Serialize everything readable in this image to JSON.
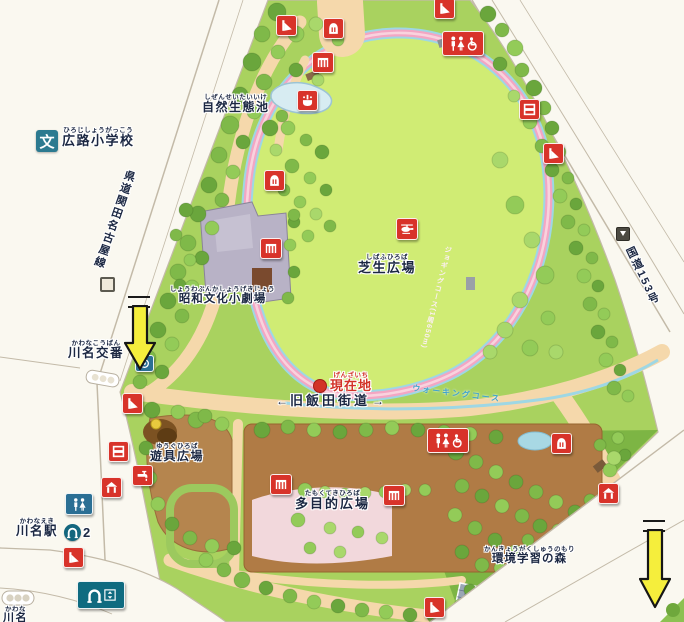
{
  "labels": {
    "school": {
      "text": "広路小学校",
      "furigana": "ひろじしょうがっこう",
      "symbol": "文"
    },
    "eco_pond": {
      "text": "自然生態池",
      "furigana": "しぜんせいたいいけ"
    },
    "pref_road": {
      "text": "県道関田名古屋線"
    },
    "theater": {
      "text": "昭和文化小劇場",
      "furigana": "しょうわぶんかしょうげきじょう"
    },
    "koban": {
      "text": "川名交番",
      "furigana": "かわなこうばん"
    },
    "lawn_plaza": {
      "text": "芝生広場",
      "furigana": "しばふひろば"
    },
    "current_location": {
      "text": "現在地",
      "furigana": "げんざいち"
    },
    "old_iida_road": {
      "text": "旧飯田街道",
      "left_arrow": "←",
      "right_arrow": "→"
    },
    "playground": {
      "text": "遊具広場",
      "furigana": "ゆうぐひろば"
    },
    "multipurpose": {
      "text": "多目的広場",
      "furigana": "たもくてきひろば"
    },
    "station": {
      "text": "川名駅",
      "furigana": "かわなえき",
      "exit_number": "2"
    },
    "station_corner": {
      "text": "川名",
      "furigana": "かわな"
    },
    "forest": {
      "text": "環境学習の森",
      "furigana": "かんきょうがくしゅうのもり"
    },
    "route153": {
      "text": "国道153号"
    },
    "jogging_course": {
      "text": "ジョギングコース(1周650m)"
    },
    "walking_course": {
      "text": "ウォーキングコース"
    }
  },
  "colors": {
    "lawn": "#d0ec74",
    "park_green": "#a9d25f",
    "forest_green": "#7db544",
    "path_tan": "#f5d8ab",
    "plaza_brown": "#b07b45",
    "jogging_pink": "#f3a6c3",
    "walking_blue": "#9ed7e4",
    "icon_red": "#d8332a",
    "icon_blue": "#2b6f94",
    "subway_teal": "#0f6b80",
    "arrow_yellow": "#f5ee3c"
  },
  "icons": [
    {
      "name": "slide-icon-north",
      "type": "slide",
      "x": 285,
      "y": 24
    },
    {
      "name": "slide-icon-top-entrance",
      "type": "slide",
      "x": 443,
      "y": 7
    },
    {
      "name": "arbor-icon-north",
      "type": "arbor",
      "x": 332,
      "y": 27
    },
    {
      "name": "kiosk-icon",
      "type": "pergola",
      "x": 322,
      "y": 61
    },
    {
      "name": "fountain-icon-pond",
      "type": "fountain",
      "x": 306,
      "y": 99
    },
    {
      "name": "toilet-icon-northeast",
      "type": "toilet-acc",
      "x": 462,
      "y": 42
    },
    {
      "name": "horizontal-bar-icon-east",
      "type": "hbar",
      "x": 528,
      "y": 108
    },
    {
      "name": "slide-icon-east",
      "type": "slide",
      "x": 552,
      "y": 152
    },
    {
      "name": "arbor-icon-west",
      "type": "arbor",
      "x": 273,
      "y": 179
    },
    {
      "name": "stage-icon",
      "type": "pergola",
      "x": 270,
      "y": 247
    },
    {
      "name": "helipad-icon",
      "type": "heli",
      "x": 406,
      "y": 228
    },
    {
      "name": "koban-icon",
      "type": "koban",
      "x": 143,
      "y": 362
    },
    {
      "name": "slide-icon-west",
      "type": "slide",
      "x": 131,
      "y": 402
    },
    {
      "name": "horizontal-bar-icon-west",
      "type": "hbar",
      "x": 117,
      "y": 450
    },
    {
      "name": "faucet-icon",
      "type": "faucet",
      "x": 141,
      "y": 474
    },
    {
      "name": "shelter-icon-west",
      "type": "shelter",
      "x": 110,
      "y": 486
    },
    {
      "name": "toilet-icon-west",
      "type": "toilet",
      "x": 78,
      "y": 503
    },
    {
      "name": "slide-icon-station",
      "type": "slide",
      "x": 72,
      "y": 556
    },
    {
      "name": "subway-sign-icon",
      "type": "subway-sign",
      "x": 100,
      "y": 594
    },
    {
      "name": "pergola-icon-multi-west",
      "type": "pergola",
      "x": 280,
      "y": 483
    },
    {
      "name": "pergola-icon-multi-east",
      "type": "pergola",
      "x": 393,
      "y": 494
    },
    {
      "name": "toilet-icon-center",
      "type": "toilet-acc",
      "x": 447,
      "y": 439
    },
    {
      "name": "arbor-icon-forest",
      "type": "arbor",
      "x": 560,
      "y": 442
    },
    {
      "name": "shelter-icon-forest",
      "type": "shelter",
      "x": 607,
      "y": 492
    },
    {
      "name": "slide-icon-south",
      "type": "slide",
      "x": 433,
      "y": 606
    }
  ]
}
